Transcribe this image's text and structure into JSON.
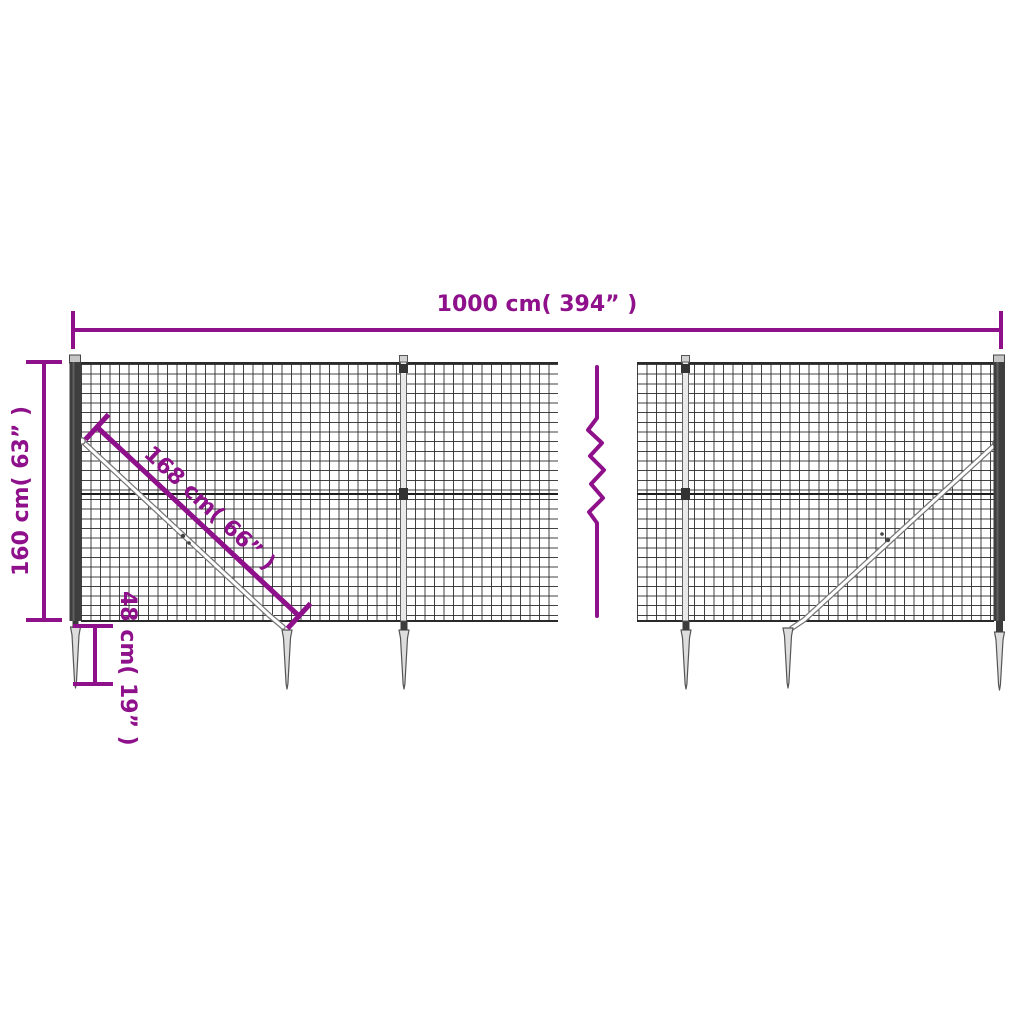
{
  "diagram": {
    "title": "wire-mesh-fence-dimension-diagram",
    "subject": "Wire mesh fence panel with posts, diagonal braces and ground anchor spikes",
    "colors": {
      "dimension_accent": "#8e108a",
      "mesh_wire": "#2d2d2d",
      "post_anthracite": "#3e3e3e",
      "hardware_gray": "#d9d9d9",
      "background": "#ffffff"
    },
    "dimensions": {
      "total_width": {
        "label": "1000 cm( 394” )",
        "value_cm": 1000,
        "value_inch": 394
      },
      "fence_height": {
        "label": "160 cm( 63” )",
        "value_cm": 160,
        "value_inch": 63
      },
      "brace_length": {
        "label": "168 cm( 66” )",
        "value_cm": 168,
        "value_inch": 66
      },
      "anchor_depth": {
        "label": "48 cm( 19” )",
        "value_cm": 48,
        "value_inch": 19
      }
    },
    "icons": [
      "break-zigzag-icon",
      "ground-spike-icon",
      "fence-post-icon",
      "diagonal-brace-icon"
    ]
  }
}
